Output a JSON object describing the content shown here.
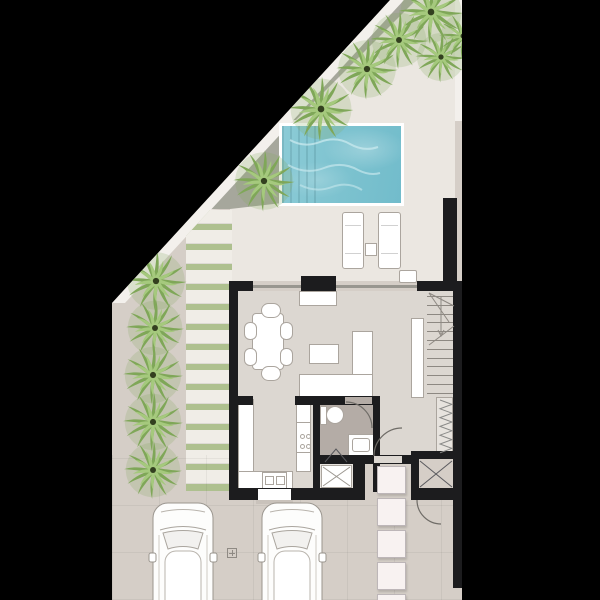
{
  "scene": {
    "title": "villa-ground-floor-plan",
    "kind": "architectural floor plan, top view"
  },
  "colors": {
    "bg": "#000000",
    "drive": "#d5cec7",
    "terrace": "#ebe7e1",
    "floor": "#dcd7d1",
    "bathFloor": "#b4aca6",
    "floorLight": "#e7e3de",
    "grass": "#c3d2a2",
    "gravel": "#a6a79c",
    "pathWhite": "#f3f0ec",
    "wall": "#1c1c1e",
    "white": "#ffffff",
    "stroke": "#aba59e",
    "glass": "#98968f",
    "pool": "#7cc2cf",
    "ripple": "#c6e7ec",
    "stone": "#f8f2f1",
    "step": "#c9c2bb",
    "plank": "#f0ede7",
    "plankGap": "#aec08f",
    "line": "#8d8882",
    "xline": "#5a5a5e"
  },
  "plot_clip": [
    [
      390,
      0
    ],
    [
      462,
      0
    ],
    [
      462,
      600
    ],
    [
      112,
      600
    ],
    [
      112,
      303
    ]
  ],
  "polys": [
    {
      "n": "pool-terrace",
      "c": "terrace",
      "pts": [
        [
          403,
          0
        ],
        [
          455,
          0
        ],
        [
          455,
          281
        ],
        [
          230,
          281
        ],
        [
          230,
          208
        ],
        [
          199,
          211
        ]
      ]
    },
    {
      "n": "grass-top-triangle",
      "c": "grass",
      "grad": true,
      "pts": [
        [
          414,
          0
        ],
        [
          455,
          0
        ],
        [
          455,
          120
        ],
        [
          292,
          120
        ]
      ]
    },
    {
      "n": "gravel-band-upper",
      "c": "gravel",
      "pts": [
        [
          403,
          0
        ],
        [
          416,
          0
        ],
        [
          296,
          120
        ],
        [
          284,
          120
        ]
      ]
    },
    {
      "n": "gravel-wedge",
      "c": "gravel",
      "pts": [
        [
          293,
          120
        ],
        [
          282,
          131
        ],
        [
          282,
          203
        ],
        [
          230,
          209
        ],
        [
          211,
          209
        ]
      ]
    },
    {
      "n": "boundary-path-diagonal",
      "c": "pathWhite",
      "pts": [
        [
          390,
          0
        ],
        [
          404,
          0
        ],
        [
          125,
          303
        ],
        [
          112,
          303
        ]
      ]
    },
    {
      "n": "grass-left-strip",
      "c": "grass",
      "grad": true,
      "pts": [
        [
          199,
          211
        ],
        [
          112,
          303
        ],
        [
          112,
          521
        ],
        [
          186,
          521
        ],
        [
          186,
          228
        ]
      ]
    }
  ],
  "rects": [
    {
      "n": "path-right-strip",
      "x": 455,
      "y": 0,
      "w": 7,
      "h": 121,
      "c": "pathWhite"
    },
    {
      "n": "tile-grid-driveway",
      "x": 112,
      "y": 455,
      "w": 350,
      "h": 145,
      "cls": "tilegrid"
    },
    {
      "n": "pool-rim",
      "x": 279,
      "y": 123,
      "w": 125,
      "h": 83,
      "c": "white"
    },
    {
      "n": "pool-water",
      "x": 282,
      "y": 126,
      "w": 119,
      "h": 77,
      "cls": "water"
    },
    {
      "n": "pool-steps",
      "x": 282,
      "y": 126,
      "w": 38,
      "h": 77,
      "cls": "steps-band"
    },
    {
      "n": "terrace-privacy-wall",
      "x": 443,
      "y": 198,
      "w": 14,
      "h": 83,
      "c": "wall"
    },
    {
      "n": "sun-lounger-left",
      "x": 342,
      "y": 212,
      "w": 22,
      "h": 57,
      "c": "white",
      "br": 1,
      "rad": 3,
      "cls": "lounger"
    },
    {
      "n": "sun-lounger-right",
      "x": 378,
      "y": 212,
      "w": 23,
      "h": 57,
      "c": "white",
      "br": 1,
      "rad": 3,
      "cls": "lounger"
    },
    {
      "n": "lounger-side-table",
      "x": 365,
      "y": 243,
      "w": 12,
      "h": 13,
      "c": "white",
      "br": 1
    },
    {
      "n": "terrace-door-mat",
      "x": 399,
      "y": 270,
      "w": 18,
      "h": 13,
      "c": "white",
      "br": 1,
      "rad": 2
    },
    {
      "n": "interior-floor",
      "x": 238,
      "y": 291,
      "w": 215,
      "h": 201,
      "c": "floor"
    },
    {
      "n": "glass-facade-line",
      "x": 253,
      "y": 285,
      "w": 164,
      "h": 3,
      "c": "glass"
    },
    {
      "n": "outdoor-bbq-counter",
      "x": 301,
      "y": 276,
      "w": 35,
      "h": 15,
      "c": "wall"
    },
    {
      "n": "sideboard",
      "x": 299,
      "y": 291,
      "w": 38,
      "h": 15,
      "c": "white",
      "br": 1
    },
    {
      "n": "bathroom-floor",
      "x": 320,
      "y": 405,
      "w": 53,
      "h": 51,
      "c": "bathFloor"
    },
    {
      "n": "shower-room-floor",
      "x": 318,
      "y": 461,
      "w": 35,
      "h": 27,
      "c": "floorLight"
    },
    {
      "n": "entry-porch-paving",
      "x": 365,
      "y": 464,
      "w": 46,
      "h": 38,
      "c": "drive"
    },
    {
      "n": "understairs-closet-bg",
      "x": 436,
      "y": 397,
      "w": 17,
      "h": 57,
      "c": "floorLight",
      "br": 1
    },
    {
      "n": "stair-stringer",
      "x": 411,
      "y": 318,
      "w": 13,
      "h": 80,
      "c": "white",
      "br": 1
    },
    {
      "n": "dining-table",
      "x": 252,
      "y": 313,
      "w": 32,
      "h": 57,
      "c": "white",
      "br": 1,
      "rad": 4
    },
    {
      "n": "dining-chair-top",
      "x": 261,
      "y": 303,
      "w": 20,
      "h": 15,
      "c": "white",
      "br": 1,
      "rad": 8
    },
    {
      "n": "dining-chair-bottom",
      "x": 261,
      "y": 366,
      "w": 20,
      "h": 15,
      "c": "white",
      "br": 1,
      "rad": 8
    },
    {
      "n": "dining-chair-left-1",
      "x": 244,
      "y": 322,
      "w": 13,
      "h": 18,
      "c": "white",
      "br": 1,
      "rad": 6
    },
    {
      "n": "dining-chair-left-2",
      "x": 244,
      "y": 348,
      "w": 13,
      "h": 18,
      "c": "white",
      "br": 1,
      "rad": 6
    },
    {
      "n": "dining-chair-right-1",
      "x": 280,
      "y": 322,
      "w": 13,
      "h": 18,
      "c": "white",
      "br": 1,
      "rad": 6
    },
    {
      "n": "dining-chair-right-2",
      "x": 280,
      "y": 348,
      "w": 13,
      "h": 18,
      "c": "white",
      "br": 1,
      "rad": 6
    },
    {
      "n": "coffee-table",
      "x": 309,
      "y": 344,
      "w": 30,
      "h": 20,
      "c": "white",
      "br": 1
    },
    {
      "n": "sofa-chaise",
      "x": 352,
      "y": 331,
      "w": 21,
      "h": 44,
      "c": "white",
      "br": 1
    },
    {
      "n": "sofa-seat",
      "x": 299,
      "y": 374,
      "w": 74,
      "h": 25,
      "c": "white",
      "br": 1,
      "cls": "cushions"
    },
    {
      "n": "kitchen-counter-left",
      "x": 238,
      "y": 399,
      "w": 16,
      "h": 73,
      "c": "white",
      "br": 1
    },
    {
      "n": "kitchen-counter-bottom",
      "x": 238,
      "y": 471,
      "w": 55,
      "h": 20,
      "c": "white",
      "br": 1
    },
    {
      "n": "kitchen-counter-right",
      "x": 296,
      "y": 404,
      "w": 15,
      "h": 68,
      "c": "white",
      "br": 1
    },
    {
      "n": "stove",
      "x": 296,
      "y": 422,
      "w": 15,
      "h": 31,
      "c": "white",
      "br": 1,
      "dots": 4
    },
    {
      "n": "kitchen-sink",
      "x": 262,
      "y": 472,
      "w": 25,
      "h": 18,
      "c": "white",
      "br": 1,
      "sink": true
    },
    {
      "n": "toilet-tank",
      "x": 320,
      "y": 406,
      "w": 7,
      "h": 19,
      "c": "white",
      "br": 1
    },
    {
      "n": "toilet-bowl",
      "x": 326,
      "y": 406,
      "w": 18,
      "h": 18,
      "c": "white",
      "br": 1,
      "rad": 9
    },
    {
      "n": "vanity",
      "x": 348,
      "y": 434,
      "w": 26,
      "h": 22,
      "c": "white",
      "br": 1
    },
    {
      "n": "vanity-basin",
      "x": 352,
      "y": 438,
      "w": 18,
      "h": 14,
      "c": "none",
      "br": 1,
      "rad": 3
    },
    {
      "n": "shower-tray",
      "x": 321,
      "y": 465,
      "w": 31,
      "h": 23,
      "c": "white",
      "br": 1
    },
    {
      "n": "storage-room-floor",
      "x": 419,
      "y": 459,
      "w": 34,
      "h": 29,
      "c": "drive"
    },
    {
      "n": "wall-top-left",
      "x": 229,
      "y": 281,
      "w": 24,
      "h": 10,
      "c": "wall"
    },
    {
      "n": "wall-top-right",
      "x": 417,
      "y": 281,
      "w": 40,
      "h": 10,
      "c": "wall"
    },
    {
      "n": "wall-left",
      "x": 229,
      "y": 281,
      "w": 9,
      "h": 219,
      "c": "wall"
    },
    {
      "n": "wall-right",
      "x": 453,
      "y": 281,
      "w": 9,
      "h": 307,
      "c": "wall"
    },
    {
      "n": "wall-bottom-left",
      "x": 229,
      "y": 488,
      "w": 131,
      "h": 12,
      "c": "wall"
    },
    {
      "n": "wall-kitchen-stub",
      "x": 229,
      "y": 396,
      "w": 24,
      "h": 9,
      "c": "wall"
    },
    {
      "n": "wall-bathroom-top",
      "x": 295,
      "y": 396,
      "w": 85,
      "h": 9,
      "c": "wall"
    },
    {
      "n": "bathroom-door-opening",
      "x": 345,
      "y": 397,
      "w": 27,
      "h": 7,
      "c": "bathFloor"
    },
    {
      "n": "wall-bathroom-left",
      "x": 313,
      "y": 396,
      "w": 7,
      "h": 96,
      "c": "wall"
    },
    {
      "n": "wall-bathroom-right",
      "x": 373,
      "y": 396,
      "w": 7,
      "h": 96,
      "c": "wall"
    },
    {
      "n": "wall-bathroom-mid",
      "x": 313,
      "y": 455,
      "w": 42,
      "h": 9,
      "c": "wall"
    },
    {
      "n": "wall-chunk",
      "x": 353,
      "y": 455,
      "w": 12,
      "h": 45,
      "c": "wall"
    },
    {
      "n": "wall-entry",
      "x": 353,
      "y": 455,
      "w": 60,
      "h": 9,
      "c": "wall"
    },
    {
      "n": "entry-door-opening",
      "x": 374,
      "y": 456,
      "w": 28,
      "h": 7,
      "c": "floor"
    },
    {
      "n": "wall-storage-top",
      "x": 411,
      "y": 451,
      "w": 46,
      "h": 8,
      "c": "wall"
    },
    {
      "n": "wall-storage-left",
      "x": 411,
      "y": 451,
      "w": 8,
      "h": 49,
      "c": "wall"
    },
    {
      "n": "wall-storage-bottom",
      "x": 411,
      "y": 488,
      "w": 46,
      "h": 12,
      "c": "wall"
    },
    {
      "n": "front-door-leaf",
      "x": 258,
      "y": 489,
      "w": 33,
      "h": 11,
      "c": "white"
    },
    {
      "n": "front-door-step",
      "x": 256,
      "y": 500,
      "w": 37,
      "h": 4,
      "c": "step"
    },
    {
      "n": "driveway-drain",
      "x": 227,
      "y": 548,
      "w": 10,
      "h": 10,
      "c": "none",
      "cls": "drain"
    }
  ],
  "planks": {
    "x": 186,
    "y": 210,
    "w": 46,
    "slabH": 14,
    "gap": 6,
    "count": 14,
    "clip": [
      [
        24,
        0
      ],
      [
        46,
        0
      ],
      [
        46,
        281
      ],
      [
        0,
        281
      ],
      [
        0,
        26
      ]
    ]
  },
  "stair_treads": {
    "x": 427,
    "y": 296,
    "w": 26,
    "count": 12,
    "pitch": 8.8
  },
  "stepping_stones": {
    "x": 377,
    "w": 29,
    "h": 28,
    "ys": [
      466,
      498,
      530,
      562,
      594
    ]
  },
  "zigzag": {
    "x1": 440,
    "x2": 452,
    "y0": 400,
    "dy": 4.4,
    "n": 12
  },
  "trees": [
    {
      "x": 431,
      "y": 12,
      "s": 0.95
    },
    {
      "x": 399,
      "y": 40,
      "s": 0.85
    },
    {
      "x": 441,
      "y": 57,
      "s": 0.75
    },
    {
      "x": 463,
      "y": 36,
      "s": 0.7
    },
    {
      "x": 367,
      "y": 69,
      "s": 0.9
    },
    {
      "x": 321,
      "y": 109,
      "s": 0.95
    },
    {
      "x": 264,
      "y": 181,
      "s": 0.9
    },
    {
      "x": 156,
      "y": 281,
      "s": 0.9
    },
    {
      "x": 155,
      "y": 328,
      "s": 0.85
    },
    {
      "x": 153,
      "y": 375,
      "s": 0.88
    },
    {
      "x": 153,
      "y": 422,
      "s": 0.88
    },
    {
      "x": 153,
      "y": 470,
      "s": 0.85
    }
  ],
  "palm": {
    "rings": [
      {
        "n": 12,
        "len": 34,
        "c": "#7fa758"
      },
      {
        "n": 9,
        "len": 24,
        "c": "#a5c97d"
      }
    ],
    "halo": "#86a861",
    "core": "#33401f"
  },
  "cars": [
    {
      "n": "car-left",
      "x": 152,
      "y": 503
    },
    {
      "n": "car-right",
      "x": 261,
      "y": 503
    }
  ],
  "svg_paths": [
    {
      "n": "bathroom-door-arc",
      "d": "M346 402 A26 26 0 0 1 372 428",
      "s": "#6f6c67",
      "w": 1.2
    },
    {
      "n": "front-door-arc",
      "d": "M374 456 A28 28 0 0 1 402 428",
      "s": "#6f6c67",
      "w": 1.2
    },
    {
      "n": "side-gate-arc",
      "d": "M417 500 A24 24 0 0 0 441 524",
      "s": "#6f6c67",
      "w": 1.2
    },
    {
      "n": "stair-winder-1",
      "d": "M429 293 L454 306",
      "s": "#8d8882",
      "w": 1
    },
    {
      "n": "stair-winder-2",
      "d": "M429 293 L449 322",
      "s": "#8d8882",
      "w": 1
    },
    {
      "n": "stair-direction-line",
      "d": "M441 297 L441 334",
      "s": "#8d8882",
      "w": 1
    },
    {
      "n": "stair-arrow-head",
      "d": "M438 330 L441 336 L444 330",
      "s": "#8d8882",
      "w": 1
    },
    {
      "n": "stair-winder-3",
      "d": "M429 345 L454 326",
      "s": "#8d8882",
      "w": 1
    },
    {
      "n": "storage-cross-1",
      "d": "M420 461 L452 487",
      "s": "#5a5a5e",
      "w": 1
    },
    {
      "n": "storage-cross-2",
      "d": "M452 461 L420 487",
      "s": "#5a5a5e",
      "w": 1
    },
    {
      "n": "shower-cross-1",
      "d": "M323 467 L350 486",
      "s": "#9b968f",
      "w": 1
    },
    {
      "n": "shower-cross-2",
      "d": "M350 467 L323 486",
      "s": "#9b968f",
      "w": 1
    },
    {
      "n": "shower-door-fold",
      "d": "M325 462 L336 449 L347 462",
      "s": "#56565a",
      "w": 1
    },
    {
      "n": "pool-ripple-1",
      "d": "M290 140 q14 8 30 2 q16 -6 30 2 q14 8 28 3",
      "s": "#c6e7ec",
      "w": 2,
      "o": 0.8
    },
    {
      "n": "pool-ripple-2",
      "d": "M288 165 q18 10 36 3 q18 -7 34 2 q12 6 22 3",
      "s": "#c6e7ec",
      "w": 2,
      "o": 0.7
    },
    {
      "n": "pool-ripple-3",
      "d": "M300 185 q16 8 32 2 q16 -6 30 3",
      "s": "#c6e7ec",
      "w": 2,
      "o": 0.6
    }
  ]
}
